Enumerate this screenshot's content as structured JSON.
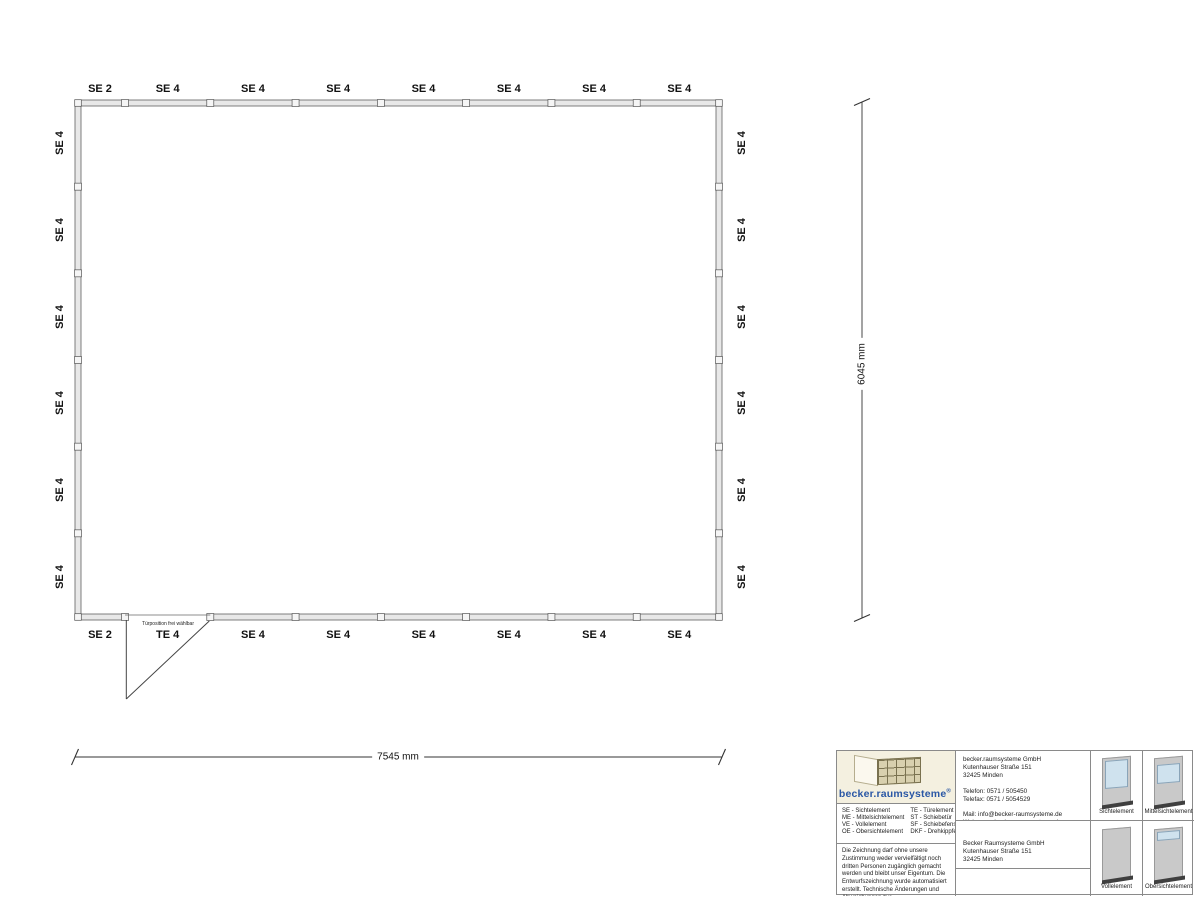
{
  "plan": {
    "top_labels": [
      "SE 2",
      "SE 4",
      "SE 4",
      "SE 4",
      "SE 4",
      "SE 4",
      "SE 4",
      "SE 4"
    ],
    "bottom_labels": [
      "SE 2",
      "TE 4",
      "SE 4",
      "SE 4",
      "SE 4",
      "SE 4",
      "SE 4",
      "SE 4"
    ],
    "left_labels": [
      "SE 4",
      "SE 4",
      "SE 4",
      "SE 4",
      "SE 4",
      "SE 4"
    ],
    "right_labels": [
      "SE 4",
      "SE 4",
      "SE 4",
      "SE 4",
      "SE 4",
      "SE 4"
    ],
    "door_note": "Türposition frei wählbar"
  },
  "dimensions": {
    "width": "7545 mm",
    "height": "6045 mm"
  },
  "titleblock": {
    "logo_text": "becker.raumsysteme",
    "logo_sup": "®",
    "legend": [
      "SE - Sichtelement",
      "ME - Mittelsichtelement",
      "VE - Vollelement",
      "OE - Obersichtelement",
      "TE - Türelement",
      "ST - Schiebetür",
      "SF - Schiebefenster",
      "DKF - Drehkippfenster"
    ],
    "disclaimer": "Die Zeichnung darf ohne unsere Zustimmung weder vervielfältigt noch dritten Personen zugänglich gemacht werden und bleibt unser Eigentum. Die Entwurfszeichnung wurde automatisiert erstellt. Technische Änderungen und Abweichungen zur Ausführungszeichnung behalten wir uns vor.",
    "supplier_lines": [
      "becker.raumsysteme GmbH",
      "Kutenhauser Straße 151",
      "32425 Minden",
      "",
      "Telefon: 0571 / 505450",
      "Telefax: 0571 / 5054529",
      "",
      "Mail: info@becker-raumsysteme.de",
      "Web: www.becker-raumsysteme.de"
    ],
    "customer_lines": [
      "Becker Raumsysteme GmbH",
      "Kutenhauser Straße 151",
      "32425 Minden"
    ],
    "elements": [
      {
        "label": "Sichtelement",
        "type": "sicht"
      },
      {
        "label": "Mittelsichtelement",
        "type": "mittel"
      },
      {
        "label": "Vollelement",
        "type": "voll"
      },
      {
        "label": "Obersichtelement",
        "type": "ober"
      }
    ]
  }
}
